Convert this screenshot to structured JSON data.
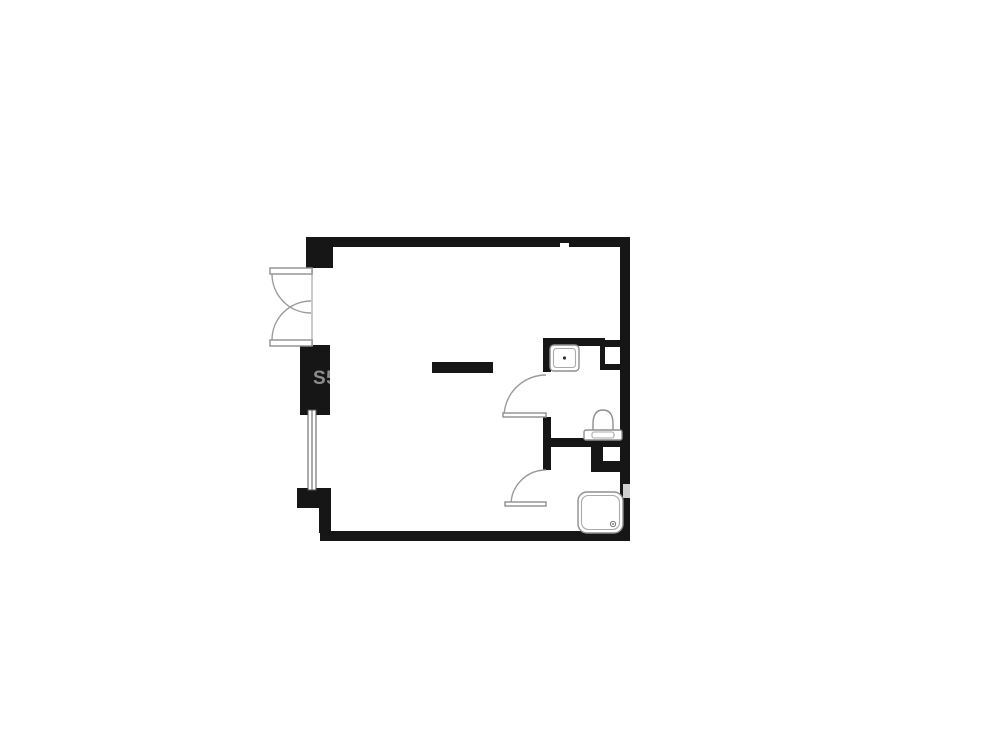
{
  "page": {
    "kind": "apartment-floor-plan",
    "description": "black-and-white studio apartment floor plan with bathroom at right"
  },
  "colors": {
    "background": "#ffffff",
    "wall": "#161616",
    "fixture_outline": "#8f8f8f",
    "window_line": "#555555",
    "threshold": "#c9c9c9",
    "wall_notch": "#cfcfcf",
    "watermark": "#8d8d8d"
  },
  "watermark": {
    "text": "S5"
  },
  "fixtures": [
    {
      "name": "entry-double-door",
      "area": "left wall, upper"
    },
    {
      "name": "window",
      "area": "left wall, lower"
    },
    {
      "name": "kitchen-counter",
      "area": "main room center"
    },
    {
      "name": "sink",
      "area": "bathroom, top"
    },
    {
      "name": "toilet",
      "area": "bathroom, middle"
    },
    {
      "name": "interior-door-bathroom",
      "area": "bathroom left"
    },
    {
      "name": "interior-door-shower",
      "area": "shower room left"
    },
    {
      "name": "shower-tray",
      "area": "bottom right"
    },
    {
      "name": "duct-upper",
      "area": "right wall beside sink"
    },
    {
      "name": "duct-lower",
      "area": "right wall below toilet"
    }
  ]
}
